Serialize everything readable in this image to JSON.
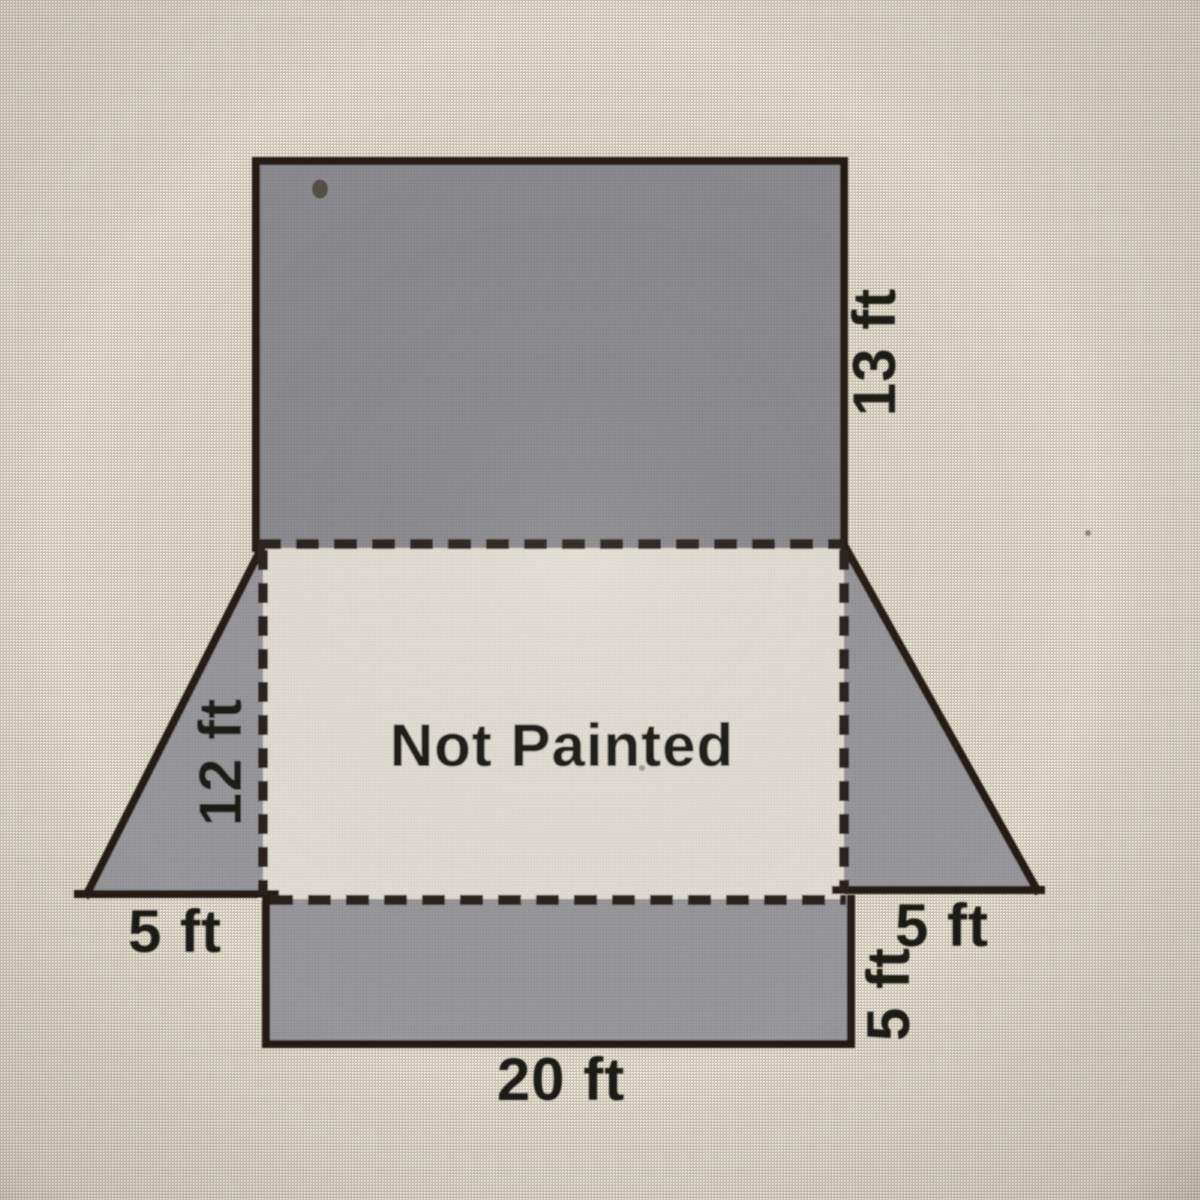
{
  "diagram": {
    "not_painted_label": "Not Painted",
    "labels": {
      "side_13ft": "13 ft",
      "side_12ft": "12 ft",
      "base_left_5ft": "5 ft",
      "base_right_5ft": "5 ft",
      "side_right_5ft": "5 ft",
      "base_20ft": "20 ft"
    },
    "colors": {
      "background": "#d8d3c5",
      "painted_face_dark": "#8b8b8e",
      "painted_face_light": "#97979b",
      "not_painted_face": "#e0ded5",
      "line": "#261f19",
      "text": "#1d1a16"
    }
  }
}
